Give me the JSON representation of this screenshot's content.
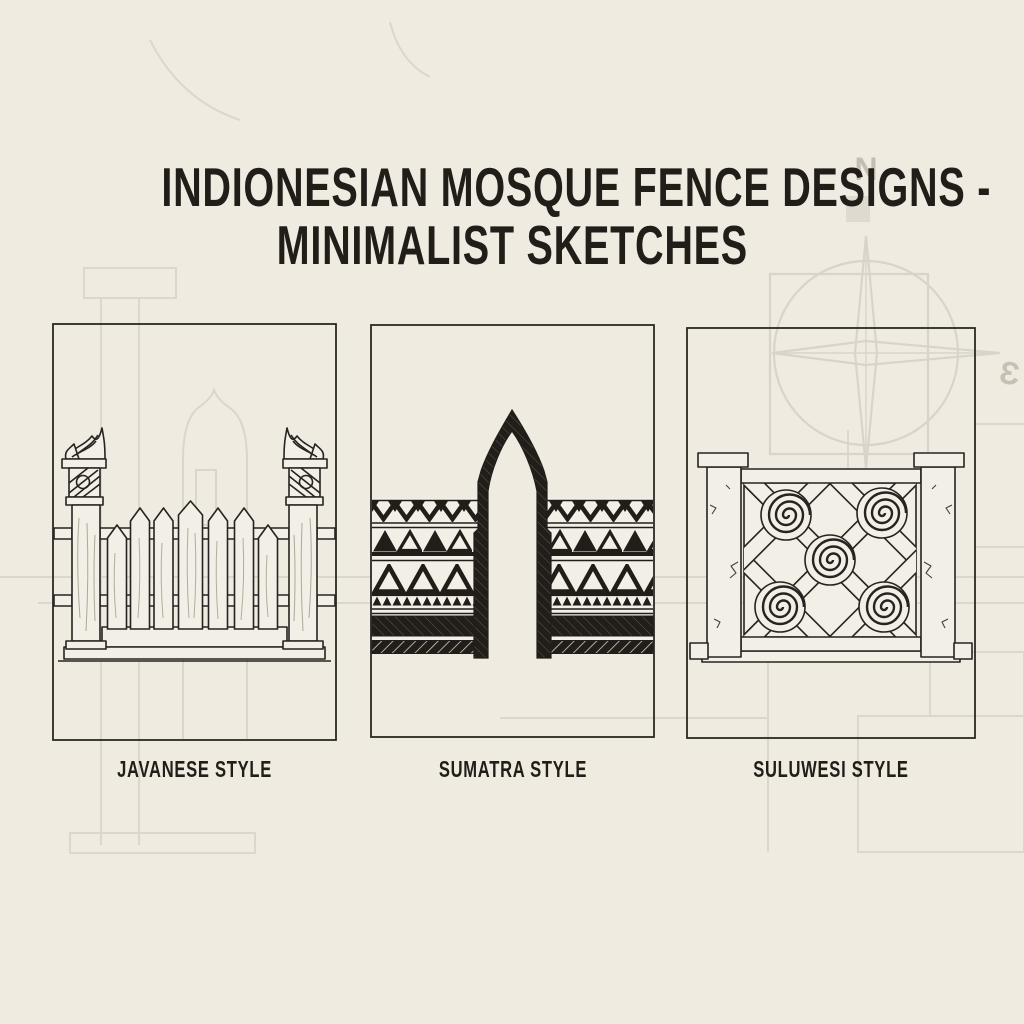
{
  "poster": {
    "title_line1": "INDIONESIAN MOSQUE FENCE DESIGNS -",
    "title_line2": "MINIMALIST SKETCHES",
    "paper_color": "#EFEBE1",
    "ink_color": "#211E1A",
    "faint_sketch_color": "#6B6252"
  },
  "panels": [
    {
      "caption": "JAVANESE STYLE",
      "illustration": "carved-post-picket-gate-sketch"
    },
    {
      "caption": "SUMATRA STYLE",
      "illustration": "tribal-triangle-bands-ogee-arch-gate-sketch"
    },
    {
      "caption": "SULUWESI STYLE",
      "illustration": "spiral-lattice-fence-panel-sketch"
    }
  ],
  "background": {
    "compass_north_label": "N",
    "compass_east_label": "Ɛ"
  }
}
